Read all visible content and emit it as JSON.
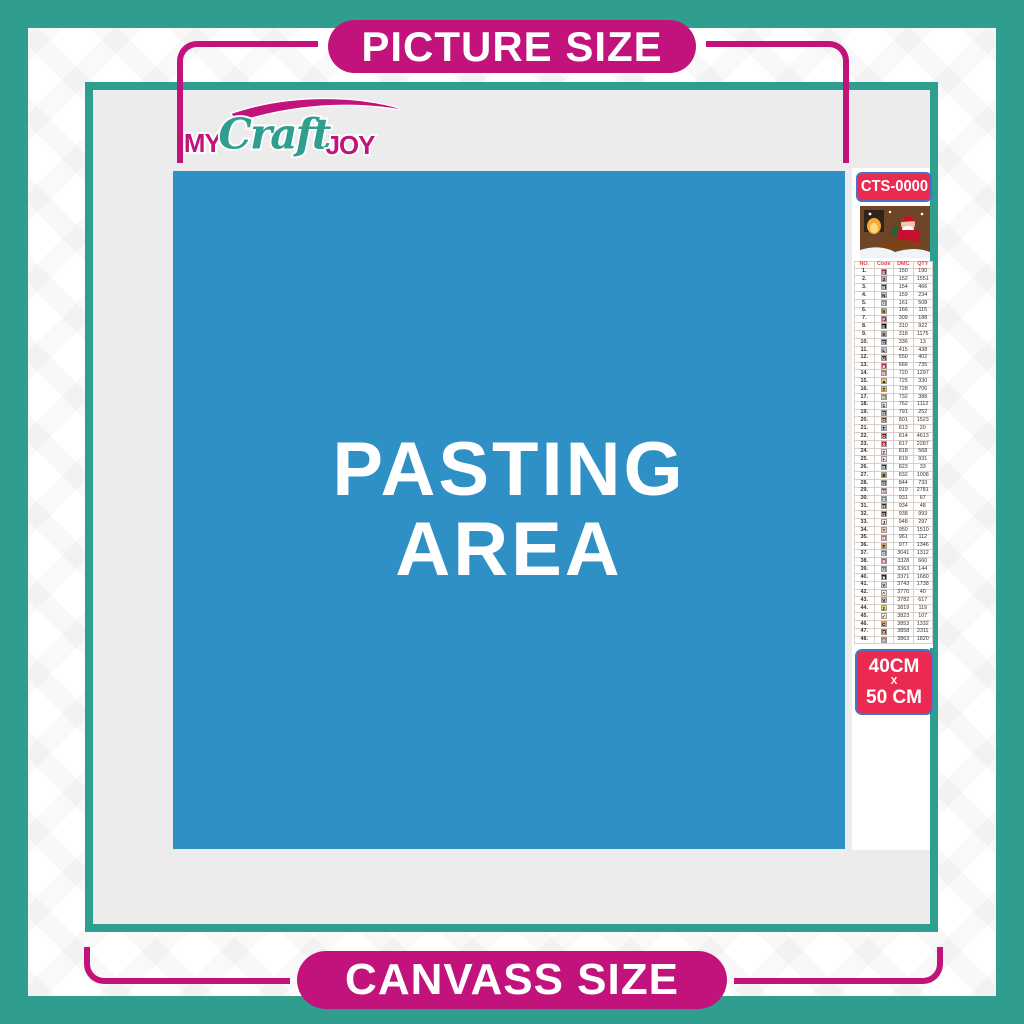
{
  "banners": {
    "top": "PICTURE SIZE",
    "bottom": "CANVASS SIZE"
  },
  "logo": {
    "word1": "MY",
    "word2": "Craft",
    "word3": "JOY"
  },
  "pasting_area": {
    "line1": "PASTING",
    "line2": "AREA"
  },
  "sidebar": {
    "sku": "CTS-0000",
    "thumbnail": "christmas-santa-scene",
    "size": {
      "line1": "40CM",
      "sep": "X",
      "line2": "50 CM"
    },
    "table": {
      "headers": [
        "NO.",
        "Code",
        "DMC",
        "QTY"
      ],
      "rows": [
        {
          "no": "1",
          "sym": "E",
          "bg": "#ab0d49",
          "tc": "#fff",
          "dmc": "150",
          "qty": "190"
        },
        {
          "no": "2",
          "sym": "3",
          "bg": "#e0a6a9",
          "tc": "#000",
          "dmc": "152",
          "qty": "1551"
        },
        {
          "no": "3",
          "sym": "B",
          "bg": "#57233f",
          "tc": "#fff",
          "dmc": "154",
          "qty": "466"
        },
        {
          "no": "4",
          "sym": "N",
          "bg": "#c3cada",
          "tc": "#000",
          "dmc": "159",
          "qty": "234"
        },
        {
          "no": "5",
          "sym": "G",
          "bg": "#7d85a5",
          "tc": "#fff",
          "dmc": "161",
          "qty": "508"
        },
        {
          "no": "6",
          "sym": "h",
          "bg": "#bdb837",
          "tc": "#000",
          "dmc": "166",
          "qty": "115"
        },
        {
          "no": "7",
          "sym": "F",
          "bg": "#ba2c4d",
          "tc": "#fff",
          "dmc": "309",
          "qty": "188"
        },
        {
          "no": "8",
          "sym": "E",
          "bg": "#000000",
          "tc": "#fff",
          "dmc": "310",
          "qty": "922"
        },
        {
          "no": "9",
          "sym": "X",
          "bg": "#a9adb3",
          "tc": "#000",
          "dmc": "318",
          "qty": "1175"
        },
        {
          "no": "10",
          "sym": "D",
          "bg": "#1f3a67",
          "tc": "#fff",
          "dmc": "336",
          "qty": "13"
        },
        {
          "no": "11",
          "sym": "L",
          "bg": "#c5c7cb",
          "tc": "#000",
          "dmc": "415",
          "qty": "438"
        },
        {
          "no": "12",
          "sym": "U",
          "bg": "#5b1a51",
          "tc": "#fff",
          "dmc": "550",
          "qty": "402"
        },
        {
          "no": "13",
          "sym": "■",
          "bg": "#e3173e",
          "tc": "#fff",
          "dmc": "666",
          "qty": "735"
        },
        {
          "no": "14",
          "sym": "N",
          "bg": "#e7571e",
          "tc": "#fff",
          "dmc": "720",
          "qty": "1297"
        },
        {
          "no": "15",
          "sym": "▲",
          "bg": "#f8c343",
          "tc": "#000",
          "dmc": "725",
          "qty": "330"
        },
        {
          "no": "16",
          "sym": "7",
          "bg": "#e9b241",
          "tc": "#000",
          "dmc": "728",
          "qty": "706"
        },
        {
          "no": "17",
          "sym": "K",
          "bg": "#94942a",
          "tc": "#fff",
          "dmc": "732",
          "qty": "388"
        },
        {
          "no": "18",
          "sym": "1",
          "bg": "#dedfe1",
          "tc": "#000",
          "dmc": "762",
          "qty": "1112"
        },
        {
          "no": "19",
          "sym": "D",
          "bg": "#3e4784",
          "tc": "#fff",
          "dmc": "791",
          "qty": "252"
        },
        {
          "no": "20",
          "sym": "O",
          "bg": "#6a3a22",
          "tc": "#fff",
          "dmc": "801",
          "qty": "1523"
        },
        {
          "no": "21",
          "sym": "T",
          "bg": "#a1c2d8",
          "tc": "#000",
          "dmc": "813",
          "qty": "20"
        },
        {
          "no": "22",
          "sym": "O",
          "bg": "#700d23",
          "tc": "#fff",
          "dmc": "814",
          "qty": "4613"
        },
        {
          "no": "23",
          "sym": "X",
          "bg": "#c11f28",
          "tc": "#fff",
          "dmc": "817",
          "qty": "2287"
        },
        {
          "no": "24",
          "sym": "7",
          "bg": "#fadee4",
          "tc": "#000",
          "dmc": "818",
          "qty": "568"
        },
        {
          "no": "25",
          "sym": "+",
          "bg": "#f9e3e6",
          "tc": "#000",
          "dmc": "819",
          "qty": "931"
        },
        {
          "no": "26",
          "sym": "B",
          "bg": "#1c2e57",
          "tc": "#fff",
          "dmc": "823",
          "qty": "33"
        },
        {
          "no": "27",
          "sym": "8",
          "bg": "#c09c3e",
          "tc": "#000",
          "dmc": "832",
          "qty": "1008"
        },
        {
          "no": "28",
          "sym": "O",
          "bg": "#4c4c4c",
          "tc": "#fff",
          "dmc": "844",
          "qty": "733"
        },
        {
          "no": "29",
          "sym": "M",
          "bg": "#a34324",
          "tc": "#fff",
          "dmc": "919",
          "qty": "2781"
        },
        {
          "no": "30",
          "sym": "S",
          "bg": "#6e8ba5",
          "tc": "#fff",
          "dmc": "931",
          "qty": "67"
        },
        {
          "no": "31",
          "sym": "H",
          "bg": "#313a1e",
          "tc": "#fff",
          "dmc": "934",
          "qty": "48"
        },
        {
          "no": "32",
          "sym": "G",
          "bg": "#3a2213",
          "tc": "#fff",
          "dmc": "938",
          "qty": "993"
        },
        {
          "no": "33",
          "sym": "J",
          "bg": "#fce8da",
          "tc": "#000",
          "dmc": "948",
          "qty": "297"
        },
        {
          "no": "34",
          "sym": "*",
          "bg": "#edc4a9",
          "tc": "#000",
          "dmc": "950",
          "qty": "1510"
        },
        {
          "no": "35",
          "sym": "R",
          "bg": "#cf6376",
          "tc": "#fff",
          "dmc": "961",
          "qty": "112"
        },
        {
          "no": "36",
          "sym": "T",
          "bg": "#da9b4f",
          "tc": "#000",
          "dmc": "977",
          "qty": "1346"
        },
        {
          "no": "37",
          "sym": "D",
          "bg": "#8e6d76",
          "tc": "#fff",
          "dmc": "3041",
          "qty": "1312"
        },
        {
          "no": "38",
          "sym": "9",
          "bg": "#c05f63",
          "tc": "#fff",
          "dmc": "3328",
          "qty": "660"
        },
        {
          "no": "39",
          "sym": "U",
          "bg": "#6f7e58",
          "tc": "#fff",
          "dmc": "3363",
          "qty": "144"
        },
        {
          "no": "40",
          "sym": "■",
          "bg": "#211509",
          "tc": "#fff",
          "dmc": "3371",
          "qty": "1680"
        },
        {
          "no": "41",
          "sym": "Y",
          "bg": "#d8cdd8",
          "tc": "#000",
          "dmc": "3743",
          "qty": "1738"
        },
        {
          "no": "42",
          "sym": "^",
          "bg": "#fbeadd",
          "tc": "#000",
          "dmc": "3770",
          "qty": "40"
        },
        {
          "no": "43",
          "sym": "V",
          "bg": "#cbb89a",
          "tc": "#000",
          "dmc": "3782",
          "qty": "617"
        },
        {
          "no": "44",
          "sym": "2",
          "bg": "#e0e868",
          "tc": "#000",
          "dmc": "3819",
          "qty": "119"
        },
        {
          "no": "45",
          "sym": "✓",
          "bg": "#fdf3cf",
          "tc": "#000",
          "dmc": "3823",
          "qty": "107"
        },
        {
          "no": "46",
          "sym": "C",
          "bg": "#ef9f4c",
          "tc": "#000",
          "dmc": "3853",
          "qty": "1332"
        },
        {
          "no": "47",
          "sym": "X",
          "bg": "#7c3b35",
          "tc": "#fff",
          "dmc": "3858",
          "qty": "2311"
        },
        {
          "no": "48",
          "sym": "A",
          "bg": "#a0805e",
          "tc": "#fff",
          "dmc": "3863",
          "qty": "1820"
        }
      ]
    }
  },
  "colors": {
    "teal": "#2F9E8E",
    "magenta": "#C1137B",
    "blue": "#2E90C5",
    "canvas_gray": "#ECECEC",
    "red": "#EA2A50",
    "badge_border": "#4A72C2",
    "table_red": "#E04040"
  }
}
